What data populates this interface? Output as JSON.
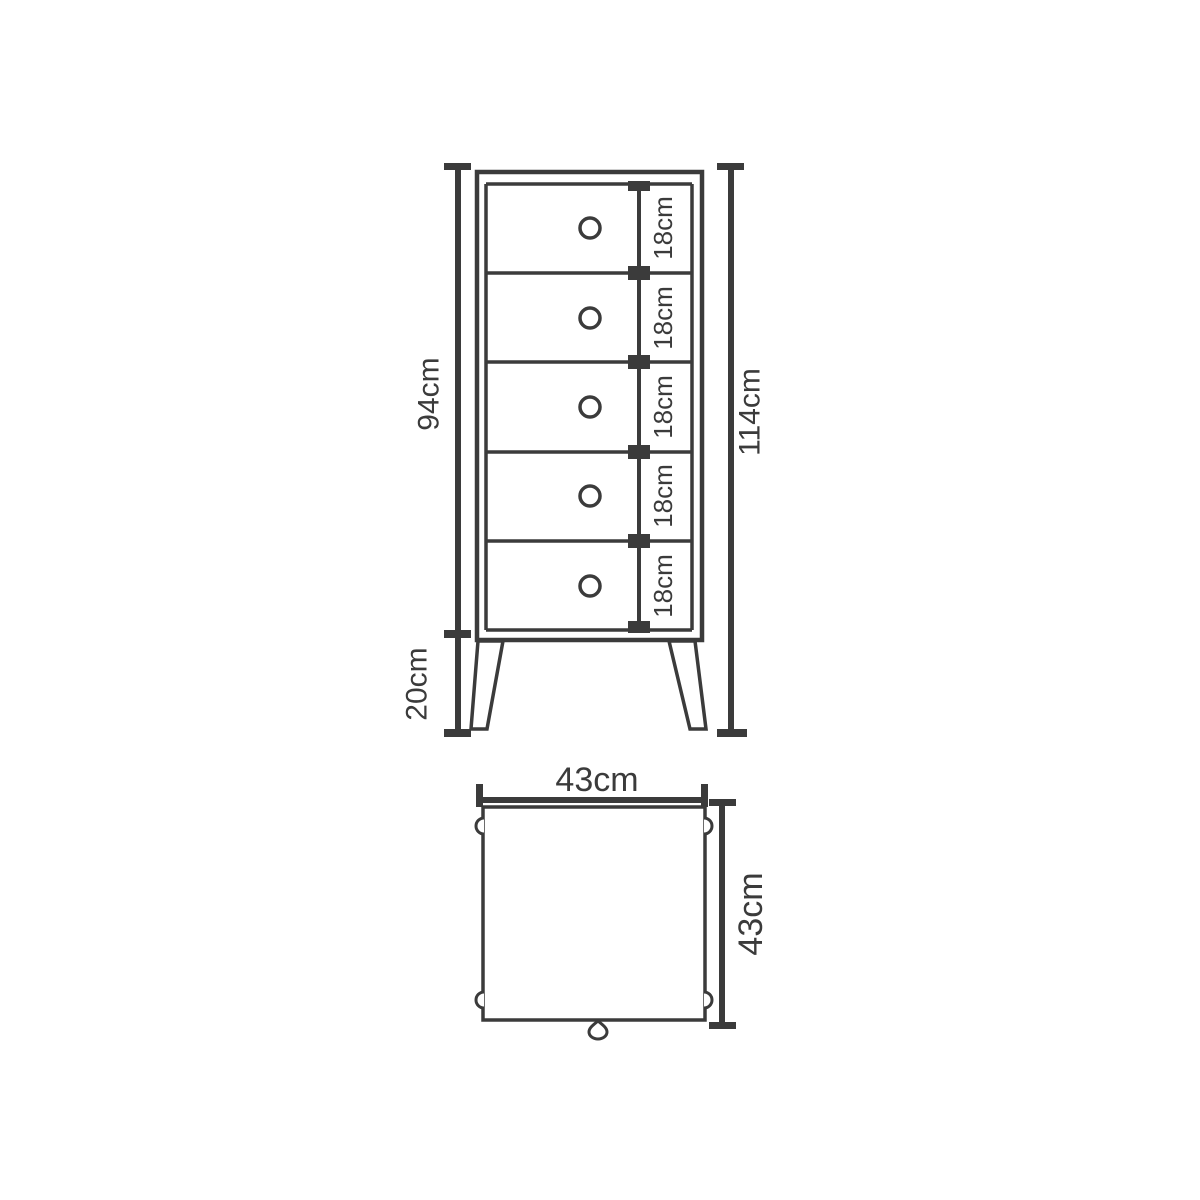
{
  "diagram": {
    "background_color": "#ffffff",
    "line_color": "#3b3b3b",
    "front_view": {
      "body_height_label": "94cm",
      "leg_height_label": "20cm",
      "total_height_label": "114cm",
      "drawers": [
        {
          "height_label": "18cm"
        },
        {
          "height_label": "18cm"
        },
        {
          "height_label": "18cm"
        },
        {
          "height_label": "18cm"
        },
        {
          "height_label": "18cm"
        }
      ]
    },
    "top_view": {
      "width_label": "43cm",
      "depth_label": "43cm"
    }
  }
}
